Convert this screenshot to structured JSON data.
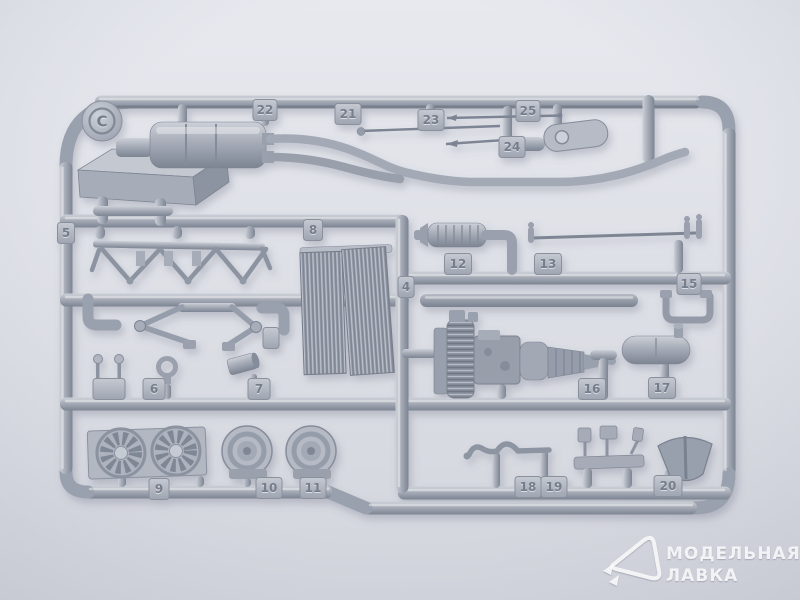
{
  "photo": {
    "subject": "model kit sprue with silver plastic parts",
    "colors": {
      "background_top": "#e7e9ef",
      "background_bottom": "#d3d5dd",
      "plastic_base": "#a6acb8",
      "plastic_highlight": "#d2d6dd",
      "plastic_shadow": "#777e8c",
      "tag_plate": "#b8bdc7",
      "watermark": "#ffffff"
    }
  },
  "sprue": {
    "letter_label": "C",
    "tags": [
      {
        "label": "5",
        "x": 66,
        "y": 233,
        "w": 17
      },
      {
        "label": "8",
        "x": 313,
        "y": 230,
        "w": 19
      },
      {
        "label": "4",
        "x": 406,
        "y": 287,
        "w": 16
      },
      {
        "label": "",
        "x": 109,
        "y": 389,
        "w": 32
      },
      {
        "label": "6",
        "x": 154,
        "y": 389,
        "w": 22
      },
      {
        "label": "7",
        "x": 259,
        "y": 389,
        "w": 22
      },
      {
        "label": "9",
        "x": 159,
        "y": 489,
        "w": 20
      },
      {
        "label": "10",
        "x": 269,
        "y": 488,
        "w": 26
      },
      {
        "label": "11",
        "x": 313,
        "y": 488,
        "w": 26
      },
      {
        "label": "12",
        "x": 458,
        "y": 264,
        "w": 27
      },
      {
        "label": "13",
        "x": 548,
        "y": 264,
        "w": 27
      },
      {
        "label": "15",
        "x": 689,
        "y": 284,
        "w": 24
      },
      {
        "label": "16",
        "x": 592,
        "y": 389,
        "w": 27
      },
      {
        "label": "17",
        "x": 662,
        "y": 388,
        "w": 27
      },
      {
        "label": "18",
        "x": 528,
        "y": 487,
        "w": 26
      },
      {
        "label": "19",
        "x": 554,
        "y": 487,
        "w": 26
      },
      {
        "label": "20",
        "x": 668,
        "y": 486,
        "w": 28
      },
      {
        "label": "21",
        "x": 348,
        "y": 114,
        "w": 26
      },
      {
        "label": "22",
        "x": 265,
        "y": 110,
        "w": 24
      },
      {
        "label": "23",
        "x": 431,
        "y": 120,
        "w": 26
      },
      {
        "label": "24",
        "x": 512,
        "y": 147,
        "w": 26
      },
      {
        "label": "25",
        "x": 528,
        "y": 111,
        "w": 24
      },
      {
        "label": "",
        "x": 271,
        "y": 338,
        "w": 16
      }
    ]
  },
  "watermark": {
    "line1": "МОДЕЛЬНАЯ",
    "line2": "ЛАВКА",
    "logo": "model-shop-pick-logo-icon"
  }
}
